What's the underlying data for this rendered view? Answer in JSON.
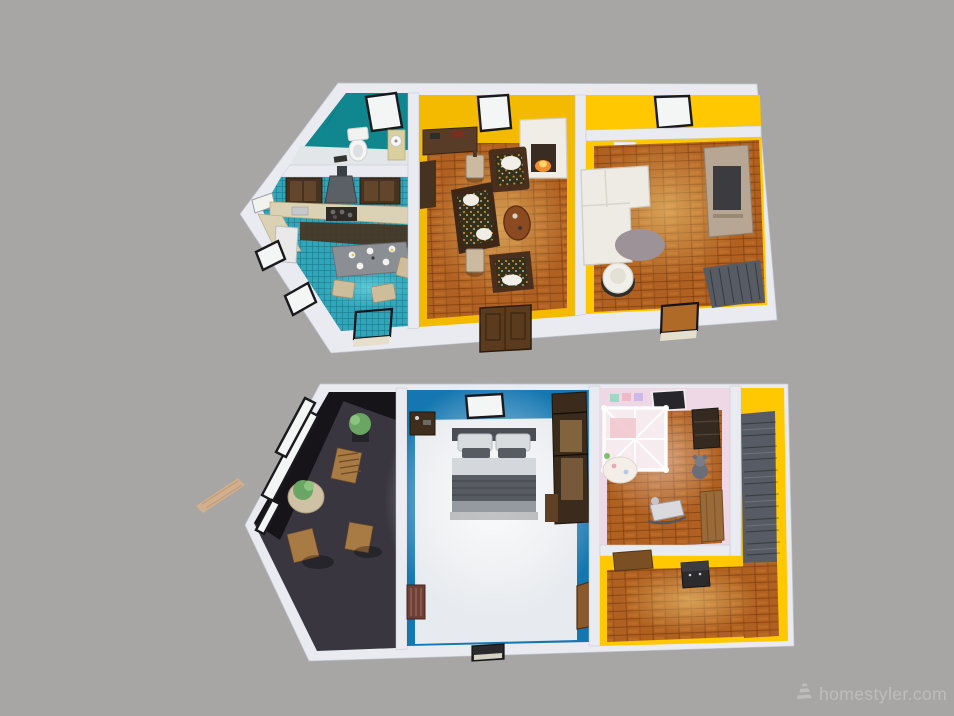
{
  "watermark": {
    "text": "homestyler.com",
    "logo_icon": "homestyler-logo"
  },
  "colors": {
    "bg": "#a7a6a5",
    "wall": "#e9ebf1",
    "wall_edge": "#c2c6d0",
    "window_pane": "#f4f6f5",
    "teal": "#10868e",
    "teal_shade": "#0a6e76",
    "bath_floor": "#e2e6e9",
    "tile": "#2fa6ba",
    "counter": "#dbd2b6",
    "cabinet": "#46331f",
    "hood_gray": "#5a6066",
    "wood": "#b06020",
    "yellow": "#f4ba00",
    "yellow_bright": "#ffc800",
    "blue": "#1577b1",
    "bedroom_floor": "#e7eaee",
    "dark_floor": "#39363f",
    "dark_wall": "#161419",
    "pink": "#eed8e6",
    "stairs": "#575c64",
    "rug": "#9c9298",
    "sofa_white": "#edebe4",
    "media_tan": "#b7a694",
    "wood_chair": "#a87a44",
    "table_gray": "#8b8e93",
    "fire": "#ef8f2e",
    "plant": "#6aa564",
    "bed_dark": "#575c63",
    "bed_mid": "#9599a0",
    "bed_light": "#d9dcdf",
    "crib": "#fbfafa",
    "wardrobe": "#3a2b1c",
    "wardrobe_panel": "#8a6a42",
    "door_wood": "#8a5a2c",
    "fridge_white": "#e9e9e9",
    "plank_tan": "#d8b28c",
    "watermark": "#c1c0bf"
  },
  "scene": {
    "type": "3d-floorplan-render",
    "floors": [
      {
        "name": "upper-floor-plan",
        "rooms": [
          {
            "name": "bathroom",
            "wall": "teal",
            "furniture": [
              "toilet",
              "sink-cabinet",
              "window"
            ]
          },
          {
            "name": "kitchen",
            "floor": "blue-tile",
            "furniture": [
              "wall-cabinets",
              "range-hood",
              "counter",
              "stove",
              "fridge",
              "dining-table",
              "chairs",
              "slant-windows"
            ]
          },
          {
            "name": "living-room",
            "wall": "yellow",
            "floor": "wood",
            "furniture": [
              "window",
              "sideboard",
              "fireplace",
              "side-cabinet",
              "armchairs",
              "floral-sofa",
              "coffee-table",
              "floor-lamps"
            ]
          },
          {
            "name": "family-room",
            "wall": "yellow",
            "floor": "wood",
            "furniture": [
              "window",
              "l-sofa",
              "media-cabinet",
              "round-rug",
              "swivel-chair",
              "staircase"
            ]
          }
        ]
      },
      {
        "name": "lower-floor-plan",
        "rooms": [
          {
            "name": "balcony-lounge",
            "floor": "dark",
            "furniture": [
              "glass-wall",
              "outdoor-chairs",
              "round-table",
              "potted-plants"
            ]
          },
          {
            "name": "bedroom",
            "wall": "blue",
            "furniture": [
              "window",
              "bed",
              "nightstand",
              "wardrobe",
              "radiator",
              "door"
            ]
          },
          {
            "name": "nursery",
            "wall": "pink",
            "floor": "wood",
            "furniture": [
              "skylight",
              "crib",
              "dresser",
              "teddy-bear",
              "play-mat",
              "rocking-horse",
              "bench"
            ]
          },
          {
            "name": "stair-hall",
            "wall": "yellow",
            "floor": "wood",
            "furniture": [
              "desk",
              "storage-chest",
              "staircase"
            ]
          }
        ]
      }
    ]
  }
}
